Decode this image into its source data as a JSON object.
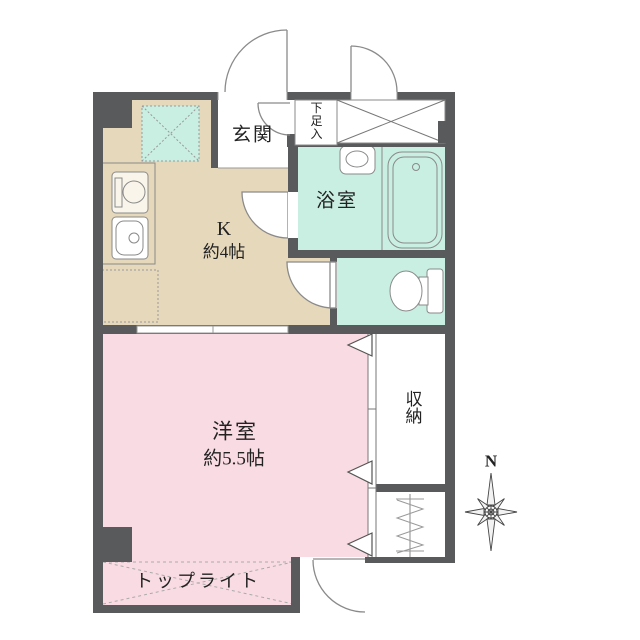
{
  "colors": {
    "wall": "#595a5c",
    "kitchen_floor": "#e6d8bb",
    "bedroom_floor": "#f9dce3",
    "wet_floor": "#c9efe2",
    "line": "#8a8a8a",
    "text": "#222222"
  },
  "rooms": {
    "entrance": {
      "label": "玄関"
    },
    "shoe_cabinet": {
      "label": "下足入"
    },
    "bathroom": {
      "label": "浴室"
    },
    "kitchen": {
      "label": "K",
      "size": "約4帖"
    },
    "western_room": {
      "label": "洋室",
      "size": "約5.5帖"
    },
    "storage": {
      "label": "収納"
    },
    "top_light": {
      "label": "トップライト"
    }
  },
  "compass": {
    "north_label": "N"
  }
}
